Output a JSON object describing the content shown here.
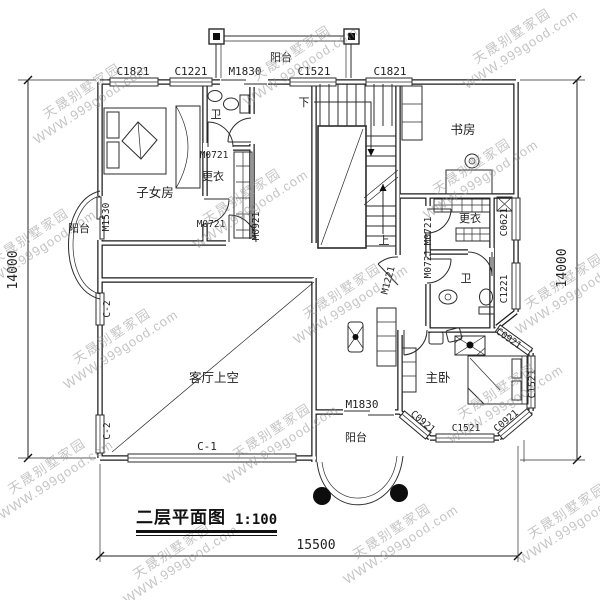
{
  "watermark": {
    "line1": "天晟别墅家园",
    "line2": "WWW.999good.com"
  },
  "title": {
    "text": "二层平面图",
    "scale": "1:100"
  },
  "plan_labels": [
    {
      "text": "C1821",
      "x": 133,
      "y": 75,
      "rot": 0,
      "cls": "code"
    },
    {
      "text": "C1221",
      "x": 191,
      "y": 75,
      "rot": 0,
      "cls": "code"
    },
    {
      "text": "M1830",
      "x": 245,
      "y": 75,
      "rot": 0,
      "cls": "code"
    },
    {
      "text": "阳台",
      "x": 281,
      "y": 61,
      "rot": 0,
      "cls": "room-s"
    },
    {
      "text": "C1521",
      "x": 314,
      "y": 75,
      "rot": 0,
      "cls": "code"
    },
    {
      "text": "C1821",
      "x": 390,
      "y": 75,
      "rot": 0,
      "cls": "code"
    },
    {
      "text": "阳台",
      "x": 79,
      "y": 232,
      "rot": 0,
      "cls": "room-s"
    },
    {
      "text": "M1530",
      "x": 109,
      "y": 217,
      "rot": -90,
      "cls": "code-s"
    },
    {
      "text": "C-2",
      "x": 110,
      "y": 309,
      "rot": -90,
      "cls": "code-s"
    },
    {
      "text": "C-2",
      "x": 110,
      "y": 431,
      "rot": -90,
      "cls": "code-s"
    },
    {
      "text": "C-1",
      "x": 207,
      "y": 450,
      "rot": 0,
      "cls": "code"
    },
    {
      "text": "14000",
      "x": 17,
      "y": 270,
      "rot": -90,
      "cls": "dim"
    },
    {
      "text": "14000",
      "x": 566,
      "y": 268,
      "rot": -90,
      "cls": "dim"
    },
    {
      "text": "15500",
      "x": 316,
      "y": 549,
      "rot": 0,
      "cls": "dim"
    },
    {
      "text": "子女房",
      "x": 155,
      "y": 197,
      "rot": 0,
      "cls": "room"
    },
    {
      "text": "卫",
      "x": 216,
      "y": 118,
      "rot": 0,
      "cls": "room-s"
    },
    {
      "text": "M0721",
      "x": 214,
      "y": 158,
      "rot": 0,
      "cls": "code-s"
    },
    {
      "text": "更衣",
      "x": 213,
      "y": 180,
      "rot": 0,
      "cls": "room-s"
    },
    {
      "text": "M0721",
      "x": 211,
      "y": 227,
      "rot": 0,
      "cls": "code-s"
    },
    {
      "text": "M0921",
      "x": 259,
      "y": 226,
      "rot": -90,
      "cls": "code-s"
    },
    {
      "text": "下",
      "x": 304,
      "y": 106,
      "rot": 0,
      "cls": "room-s"
    },
    {
      "text": "上",
      "x": 384,
      "y": 244,
      "rot": 0,
      "cls": "room-s"
    },
    {
      "text": "M1221",
      "x": 391,
      "y": 281,
      "rot": -75,
      "cls": "code-s"
    },
    {
      "text": "书房",
      "x": 463,
      "y": 134,
      "rot": 0,
      "cls": "room"
    },
    {
      "text": "M0721",
      "x": 431,
      "y": 231,
      "rot": -90,
      "cls": "code-s"
    },
    {
      "text": "M0721",
      "x": 431,
      "y": 264,
      "rot": -90,
      "cls": "code-s"
    },
    {
      "text": "更衣",
      "x": 470,
      "y": 222,
      "rot": 0,
      "cls": "room-s"
    },
    {
      "text": "C0621",
      "x": 507,
      "y": 222,
      "rot": -90,
      "cls": "code-s"
    },
    {
      "text": "卫",
      "x": 466,
      "y": 282,
      "rot": 0,
      "cls": "room-s"
    },
    {
      "text": "C1221",
      "x": 507,
      "y": 289,
      "rot": -90,
      "cls": "code-s"
    },
    {
      "text": "客厅上空",
      "x": 214,
      "y": 382,
      "rot": 0,
      "cls": "room"
    },
    {
      "text": "主卧",
      "x": 438,
      "y": 382,
      "rot": 0,
      "cls": "room"
    },
    {
      "text": "M1830",
      "x": 362,
      "y": 408,
      "rot": 0,
      "cls": "code"
    },
    {
      "text": "阳台",
      "x": 356,
      "y": 441,
      "rot": 0,
      "cls": "room-s"
    },
    {
      "text": "C0921",
      "x": 507,
      "y": 341,
      "rot": 35,
      "cls": "code-s"
    },
    {
      "text": "C0921",
      "x": 508,
      "y": 423,
      "rot": -40,
      "cls": "code-s"
    },
    {
      "text": "C0921",
      "x": 421,
      "y": 424,
      "rot": 40,
      "cls": "code-s"
    },
    {
      "text": "C1521",
      "x": 466,
      "y": 431,
      "rot": 0,
      "cls": "code-s"
    },
    {
      "text": "C1521",
      "x": 535,
      "y": 384,
      "rot": -90,
      "cls": "code-s"
    }
  ]
}
